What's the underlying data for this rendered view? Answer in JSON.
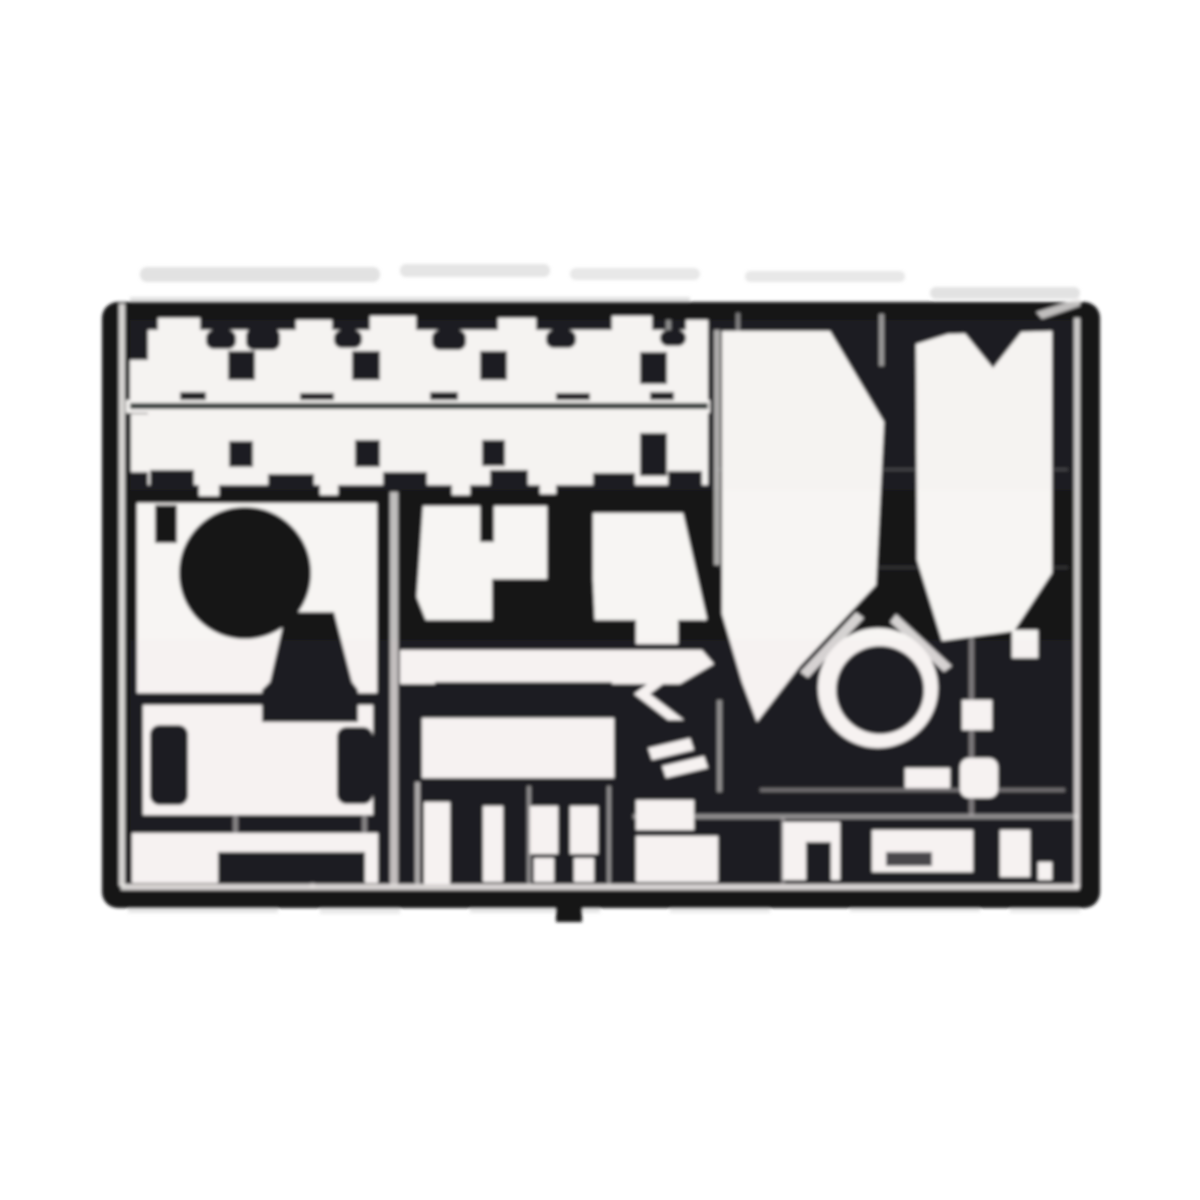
{
  "meta": {
    "subject": "photo-etched-parts-fret-scan",
    "background_color": "#ffffff"
  },
  "palette": {
    "bg": "#ffffff",
    "sheet": "#141418",
    "part": "#f7f5f3",
    "line": "#ebe9e7",
    "divider": "#26302c",
    "noise": "#c6c6c6",
    "noiseDark": "#a8a8a8",
    "tintPink": "#e8c8d2",
    "tintGreen": "#cfe0d4"
  },
  "canvas": {
    "width": 1200,
    "height": 1200,
    "blur": 1.5
  },
  "shapes": [
    {
      "n": "scan-noise-top-1",
      "k": "rect",
      "x": 140,
      "y": 267,
      "w": 240,
      "h": 15,
      "rx": 7,
      "f": "noise",
      "o": 0.5
    },
    {
      "n": "scan-noise-top-2",
      "k": "rect",
      "x": 400,
      "y": 264,
      "w": 150,
      "h": 13,
      "rx": 6,
      "f": "noise",
      "o": 0.45
    },
    {
      "n": "scan-noise-top-3",
      "k": "rect",
      "x": 570,
      "y": 268,
      "w": 130,
      "h": 12,
      "rx": 6,
      "f": "noise",
      "o": 0.4
    },
    {
      "n": "scan-noise-top-4",
      "k": "rect",
      "x": 745,
      "y": 271,
      "w": 160,
      "h": 11,
      "rx": 5,
      "f": "noise",
      "o": 0.4
    },
    {
      "n": "scan-noise-top-5",
      "k": "rect",
      "x": 930,
      "y": 287,
      "w": 150,
      "h": 12,
      "rx": 6,
      "f": "noise",
      "o": 0.5
    },
    {
      "n": "scan-noise-top-edge",
      "k": "rect",
      "x": 130,
      "y": 297,
      "w": 560,
      "h": 12,
      "f": "noiseDark",
      "o": 0.35
    },
    {
      "n": "scan-noise-bottom-1",
      "k": "rect",
      "x": 128,
      "y": 903,
      "w": 150,
      "h": 10,
      "f": "noise",
      "o": 0.4
    },
    {
      "n": "scan-noise-bottom-2",
      "k": "rect",
      "x": 320,
      "y": 906,
      "w": 80,
      "h": 8,
      "f": "noise",
      "o": 0.35
    },
    {
      "n": "scan-noise-bottom-3",
      "k": "rect",
      "x": 470,
      "y": 904,
      "w": 130,
      "h": 9,
      "f": "noise",
      "o": 0.4
    },
    {
      "n": "scan-noise-bottom-4",
      "k": "rect",
      "x": 670,
      "y": 905,
      "w": 100,
      "h": 8,
      "f": "noise",
      "o": 0.35
    },
    {
      "n": "scan-noise-bottom-5",
      "k": "rect",
      "x": 850,
      "y": 903,
      "w": 130,
      "h": 9,
      "f": "noise",
      "o": 0.4
    },
    {
      "n": "scan-noise-bottom-6",
      "k": "rect",
      "x": 1010,
      "y": 905,
      "w": 70,
      "h": 8,
      "f": "noise",
      "o": 0.35
    },
    {
      "n": "fret-sheet",
      "k": "rect",
      "x": 102,
      "y": 302,
      "w": 998,
      "h": 606,
      "rx": 16,
      "f": "sheet"
    },
    {
      "n": "sprue-tab-bottom",
      "k": "rect",
      "x": 556,
      "y": 886,
      "w": 26,
      "h": 36,
      "f": "sheet"
    },
    {
      "n": "frame-line-left",
      "k": "rect",
      "x": 119,
      "y": 304,
      "w": 6,
      "h": 582,
      "f": "line",
      "o": 0.9
    },
    {
      "n": "frame-line-right",
      "k": "rect",
      "x": 1074,
      "y": 318,
      "w": 6,
      "h": 570,
      "f": "line",
      "o": 0.85
    },
    {
      "n": "frame-line-bottom",
      "k": "rect",
      "x": 121,
      "y": 884,
      "w": 958,
      "h": 6,
      "f": "line",
      "o": 0.9
    },
    {
      "n": "frame-corner-top-right",
      "k": "polygon",
      "pts": "1036,312 1080,298 1080,306 1042,319",
      "f": "line",
      "o": 0.8
    },
    {
      "n": "sprue-line-v-392",
      "k": "rect",
      "x": 390,
      "y": 487,
      "w": 8,
      "h": 398,
      "f": "line",
      "o": 0.8
    },
    {
      "n": "sprue-line-v-637",
      "k": "rect",
      "x": 636,
      "y": 316,
      "w": 4,
      "h": 70,
      "f": "line",
      "o": 0.5
    },
    {
      "n": "sprue-line-v-668",
      "k": "rect",
      "x": 666,
      "y": 320,
      "w": 5,
      "h": 165,
      "f": "line",
      "o": 0.55
    },
    {
      "n": "sprue-line-v-716-top",
      "k": "rect",
      "x": 714,
      "y": 330,
      "w": 6,
      "h": 235,
      "f": "line",
      "o": 0.7
    },
    {
      "n": "sprue-line-v-720-bottom",
      "k": "rect",
      "x": 717,
      "y": 700,
      "w": 5,
      "h": 92,
      "f": "line",
      "o": 0.55
    },
    {
      "n": "sprue-line-v-881",
      "k": "rect",
      "x": 879,
      "y": 314,
      "w": 5,
      "h": 52,
      "f": "line",
      "o": 0.6
    },
    {
      "n": "sprue-line-v-737",
      "k": "rect",
      "x": 736,
      "y": 313,
      "w": 4,
      "h": 24,
      "f": "line",
      "o": 0.5
    },
    {
      "n": "sprue-line-v-971",
      "k": "rect",
      "x": 969,
      "y": 610,
      "w": 5,
      "h": 205,
      "f": "line",
      "o": 0.45
    },
    {
      "n": "sprue-line-v-417",
      "k": "rect",
      "x": 415,
      "y": 782,
      "w": 5,
      "h": 102,
      "f": "line",
      "o": 0.7
    },
    {
      "n": "sprue-line-v-529",
      "k": "rect",
      "x": 527,
      "y": 786,
      "w": 4,
      "h": 98,
      "f": "line",
      "o": 0.55
    },
    {
      "n": "sprue-line-v-609",
      "k": "rect",
      "x": 607,
      "y": 786,
      "w": 4,
      "h": 98,
      "f": "line",
      "o": 0.55
    },
    {
      "n": "sprue-line-v-234",
      "k": "rect",
      "x": 233,
      "y": 812,
      "w": 5,
      "h": 24,
      "f": "line",
      "o": 0.5
    },
    {
      "n": "sprue-line-v-311",
      "k": "rect",
      "x": 310,
      "y": 850,
      "w": 5,
      "h": 38,
      "f": "line",
      "o": 0.5
    },
    {
      "n": "sprue-line-v-364",
      "k": "rect",
      "x": 362,
      "y": 812,
      "w": 5,
      "h": 24,
      "f": "line",
      "o": 0.5
    },
    {
      "n": "sprue-line-v-783",
      "k": "rect",
      "x": 781,
      "y": 818,
      "w": 4,
      "h": 66,
      "f": "line",
      "o": 0.45
    },
    {
      "n": "sprue-line-h-470",
      "k": "rect",
      "x": 718,
      "y": 468,
      "w": 350,
      "h": 3,
      "f": "line",
      "o": 0.18
    },
    {
      "n": "sprue-line-h-567",
      "k": "rect",
      "x": 718,
      "y": 566,
      "w": 350,
      "h": 3,
      "f": "line",
      "o": 0.14
    },
    {
      "n": "sprue-line-h-790",
      "k": "rect",
      "x": 760,
      "y": 788,
      "w": 305,
      "h": 4,
      "f": "line",
      "o": 0.4
    },
    {
      "n": "sprue-line-h-816",
      "k": "rect",
      "x": 633,
      "y": 814,
      "w": 445,
      "h": 5,
      "f": "line",
      "o": 0.55
    },
    {
      "n": "zimmerit-band-1",
      "k": "rect",
      "x": 148,
      "y": 330,
      "w": 560,
      "h": 72,
      "f": "part"
    },
    {
      "n": "band1-left-tab",
      "k": "rect",
      "x": 130,
      "y": 360,
      "w": 20,
      "h": 42,
      "f": "part"
    },
    {
      "n": "band1-peak-1",
      "k": "rect",
      "x": 158,
      "y": 318,
      "w": 42,
      "h": 16,
      "f": "part"
    },
    {
      "n": "band1-peak-2",
      "k": "rect",
      "x": 296,
      "y": 320,
      "w": 36,
      "h": 14,
      "f": "part"
    },
    {
      "n": "band1-peak-3",
      "k": "rect",
      "x": 370,
      "y": 316,
      "w": 46,
      "h": 16,
      "f": "part"
    },
    {
      "n": "band1-peak-4",
      "k": "rect",
      "x": 498,
      "y": 318,
      "w": 38,
      "h": 14,
      "f": "part"
    },
    {
      "n": "band1-peak-5",
      "k": "rect",
      "x": 612,
      "y": 316,
      "w": 40,
      "h": 16,
      "f": "part"
    },
    {
      "n": "band1-peak-6",
      "k": "rect",
      "x": 686,
      "y": 320,
      "w": 22,
      "h": 12,
      "f": "part"
    },
    {
      "n": "band1-dip-1",
      "k": "rect",
      "x": 206,
      "y": 330,
      "w": 30,
      "h": 19,
      "rx": 8,
      "f": "sheet"
    },
    {
      "n": "band1-dip-2",
      "k": "rect",
      "x": 246,
      "y": 328,
      "w": 34,
      "h": 22,
      "rx": 8,
      "f": "sheet"
    },
    {
      "n": "band1-dip-3",
      "k": "rect",
      "x": 334,
      "y": 330,
      "w": 28,
      "h": 18,
      "rx": 8,
      "f": "sheet"
    },
    {
      "n": "band1-dip-4",
      "k": "rect",
      "x": 432,
      "y": 330,
      "w": 34,
      "h": 20,
      "rx": 8,
      "f": "sheet"
    },
    {
      "n": "band1-dip-5",
      "k": "rect",
      "x": 546,
      "y": 330,
      "w": 30,
      "h": 18,
      "rx": 8,
      "f": "sheet"
    },
    {
      "n": "band1-dip-6",
      "k": "rect",
      "x": 660,
      "y": 330,
      "w": 26,
      "h": 16,
      "rx": 8,
      "f": "sheet"
    },
    {
      "n": "band1-square-hole-1",
      "k": "rect",
      "x": 228,
      "y": 351,
      "w": 27,
      "h": 29,
      "f": "sheet"
    },
    {
      "n": "band1-square-hole-2",
      "k": "rect",
      "x": 352,
      "y": 351,
      "w": 28,
      "h": 29,
      "f": "sheet"
    },
    {
      "n": "band1-square-hole-3",
      "k": "rect",
      "x": 480,
      "y": 351,
      "w": 27,
      "h": 29,
      "f": "sheet"
    },
    {
      "n": "band1-square-hole-4",
      "k": "rect",
      "x": 640,
      "y": 352,
      "w": 27,
      "h": 32,
      "f": "sheet"
    },
    {
      "n": "band1-tooth-1",
      "k": "rect",
      "x": 180,
      "y": 392,
      "w": 26,
      "h": 12,
      "f": "sheet"
    },
    {
      "n": "band1-tooth-2",
      "k": "rect",
      "x": 300,
      "y": 393,
      "w": 34,
      "h": 11,
      "f": "sheet"
    },
    {
      "n": "band1-tooth-3",
      "k": "rect",
      "x": 430,
      "y": 392,
      "w": 28,
      "h": 12,
      "f": "sheet"
    },
    {
      "n": "band1-tooth-4",
      "k": "rect",
      "x": 556,
      "y": 393,
      "w": 34,
      "h": 11,
      "f": "sheet"
    },
    {
      "n": "band1-tooth-5",
      "k": "rect",
      "x": 650,
      "y": 392,
      "w": 24,
      "h": 12,
      "f": "sheet"
    },
    {
      "n": "divider-white-strip",
      "k": "rect",
      "x": 126,
      "y": 400,
      "w": 584,
      "h": 13,
      "f": "part"
    },
    {
      "n": "divider-dark-line",
      "k": "rect",
      "x": 130,
      "y": 403,
      "w": 578,
      "h": 6,
      "f": "divider"
    },
    {
      "n": "zimmerit-band-2",
      "k": "rect",
      "x": 148,
      "y": 413,
      "w": 560,
      "h": 72,
      "f": "part"
    },
    {
      "n": "band2-left-tab",
      "k": "rect",
      "x": 131,
      "y": 414,
      "w": 19,
      "h": 58,
      "f": "part"
    },
    {
      "n": "band2-square-hole-1",
      "k": "rect",
      "x": 229,
      "y": 441,
      "w": 24,
      "h": 26,
      "f": "sheet"
    },
    {
      "n": "band2-square-hole-2",
      "k": "rect",
      "x": 355,
      "y": 440,
      "w": 25,
      "h": 27,
      "f": "sheet"
    },
    {
      "n": "band2-square-hole-3",
      "k": "rect",
      "x": 482,
      "y": 440,
      "w": 23,
      "h": 26,
      "f": "sheet"
    },
    {
      "n": "band2-square-hole-4",
      "k": "rect",
      "x": 640,
      "y": 433,
      "w": 27,
      "h": 43,
      "f": "sheet"
    },
    {
      "n": "band2-tooth-1",
      "k": "rect",
      "x": 150,
      "y": 470,
      "w": 44,
      "h": 22,
      "f": "sheet"
    },
    {
      "n": "band2-tooth-2",
      "k": "rect",
      "x": 268,
      "y": 474,
      "w": 46,
      "h": 18,
      "f": "sheet"
    },
    {
      "n": "band2-tooth-3",
      "k": "rect",
      "x": 383,
      "y": 472,
      "w": 44,
      "h": 20,
      "f": "sheet"
    },
    {
      "n": "band2-tooth-4",
      "k": "rect",
      "x": 490,
      "y": 470,
      "w": 38,
      "h": 22,
      "f": "sheet"
    },
    {
      "n": "band2-tooth-5",
      "k": "rect",
      "x": 593,
      "y": 473,
      "w": 42,
      "h": 19,
      "f": "sheet"
    },
    {
      "n": "band2-tooth-6",
      "k": "rect",
      "x": 668,
      "y": 471,
      "w": 34,
      "h": 20,
      "f": "sheet"
    },
    {
      "n": "band2-nub-1",
      "k": "rect",
      "x": 199,
      "y": 480,
      "w": 20,
      "h": 16,
      "f": "part"
    },
    {
      "n": "band2-nub-2",
      "k": "rect",
      "x": 320,
      "y": 482,
      "w": 18,
      "h": 13,
      "f": "part"
    },
    {
      "n": "band2-nub-3",
      "k": "rect",
      "x": 452,
      "y": 480,
      "w": 18,
      "h": 15,
      "f": "part"
    },
    {
      "n": "band2-nub-4",
      "k": "rect",
      "x": 540,
      "y": 482,
      "w": 16,
      "h": 12,
      "f": "part"
    },
    {
      "n": "left-panel-upper",
      "k": "rect",
      "x": 137,
      "y": 503,
      "w": 240,
      "h": 190,
      "f": "part"
    },
    {
      "n": "left-panel-lower",
      "k": "rect",
      "x": 143,
      "y": 705,
      "w": 230,
      "h": 110,
      "f": "part"
    },
    {
      "n": "left-strip-bottom",
      "k": "rect",
      "x": 132,
      "y": 833,
      "w": 246,
      "h": 50,
      "f": "part"
    },
    {
      "n": "large-disc-hole",
      "k": "circle",
      "cx": 245,
      "cy": 573,
      "r": 66,
      "f": "sheet"
    },
    {
      "n": "funnel-cutout",
      "k": "polygon",
      "pts": "286,612 334,612 352,682 358,690 358,722 262,722 262,690 270,682",
      "f": "sheet"
    },
    {
      "n": "panel-tab-cutout",
      "k": "rect",
      "x": 155,
      "y": 505,
      "w": 22,
      "h": 38,
      "f": "sheet"
    },
    {
      "n": "knob-cutout-1",
      "k": "rect",
      "x": 150,
      "y": 725,
      "w": 38,
      "h": 80,
      "rx": 10,
      "f": "sheet"
    },
    {
      "n": "knob-cutout-2",
      "k": "rect",
      "x": 337,
      "y": 727,
      "w": 36,
      "h": 77,
      "rx": 10,
      "f": "sheet"
    },
    {
      "n": "bottom-strip-bar",
      "k": "rect",
      "x": 218,
      "y": 852,
      "w": 147,
      "h": 31,
      "f": "sheet"
    },
    {
      "n": "mid-panel-left",
      "k": "polygon",
      "pts": "402,506 547,506 547,623 427,623 402,560",
      "f": "part"
    },
    {
      "n": "mid-panel-right",
      "k": "polygon",
      "pts": "593,513 683,513 707,619 698,625 595,625 593,580",
      "f": "part"
    },
    {
      "n": "mid-wedge-cutout",
      "k": "polygon",
      "pts": "399,506 423,506 412,664 403,664",
      "f": "sheet"
    },
    {
      "n": "mid-tab-cutout",
      "k": "rect",
      "x": 480,
      "y": 506,
      "w": 14,
      "h": 36,
      "f": "sheet"
    },
    {
      "n": "mid-rect-cutout",
      "k": "rect",
      "x": 492,
      "y": 579,
      "w": 78,
      "h": 46,
      "f": "sheet"
    },
    {
      "n": "mid-bench-bar",
      "k": "rect",
      "x": 402,
      "y": 620,
      "w": 302,
      "h": 32,
      "f": "sheet"
    },
    {
      "n": "mid-arrow-bar",
      "k": "polygon",
      "pts": "400,650 702,650 714,664 680,684 400,684",
      "f": "part"
    },
    {
      "n": "mid-under-bar",
      "k": "rect",
      "x": 435,
      "y": 682,
      "w": 177,
      "h": 34,
      "f": "sheet"
    },
    {
      "n": "mid-block",
      "k": "rect",
      "x": 422,
      "y": 718,
      "w": 192,
      "h": 60,
      "f": "part"
    },
    {
      "n": "small-part-1",
      "k": "rect",
      "x": 424,
      "y": 802,
      "w": 26,
      "h": 82,
      "f": "part"
    },
    {
      "n": "small-part-2",
      "k": "rect",
      "x": 483,
      "y": 806,
      "w": 20,
      "h": 76,
      "f": "part"
    },
    {
      "n": "small-part-3a",
      "k": "rect",
      "x": 530,
      "y": 806,
      "w": 28,
      "h": 48,
      "f": "part"
    },
    {
      "n": "small-part-3b",
      "k": "rect",
      "x": 534,
      "y": 858,
      "w": 20,
      "h": 24,
      "f": "part"
    },
    {
      "n": "small-part-4a",
      "k": "rect",
      "x": 570,
      "y": 806,
      "w": 28,
      "h": 48,
      "f": "part"
    },
    {
      "n": "small-part-4b",
      "k": "rect",
      "x": 574,
      "y": 858,
      "w": 20,
      "h": 24,
      "f": "part"
    },
    {
      "n": "center-bit-square",
      "k": "rect",
      "x": 636,
      "y": 608,
      "w": 42,
      "h": 36,
      "f": "part"
    },
    {
      "n": "center-chevron-part",
      "k": "polygon",
      "pts": "684,668 668,668 634,694 668,720 684,720 650,694",
      "f": "part"
    },
    {
      "n": "center-sliver-1",
      "k": "polygon",
      "pts": "648,748 690,738 694,750 652,760",
      "f": "part"
    },
    {
      "n": "center-sliver-2",
      "k": "polygon",
      "pts": "662,766 704,756 708,768 666,778",
      "f": "part"
    },
    {
      "n": "center-bit-low-1",
      "k": "rect",
      "x": 636,
      "y": 800,
      "w": 58,
      "h": 30,
      "f": "part"
    },
    {
      "n": "center-bit-low-2",
      "k": "rect",
      "x": 636,
      "y": 836,
      "w": 82,
      "h": 46,
      "f": "part"
    },
    {
      "n": "fender-panel-left",
      "k": "polygon",
      "pts": "722,331 830,331 884,422 876,585 800,666 757,722 742,682 722,614",
      "f": "part"
    },
    {
      "n": "fender-panel-right",
      "k": "polygon",
      "pts": "916,344 948,334 1052,331 1052,573 1014,631 942,641 917,560",
      "f": "part"
    },
    {
      "n": "fender-notch-cutout",
      "k": "polygon",
      "pts": "963,331 1022,331 993,368",
      "f": "sheet"
    },
    {
      "n": "mantlet-edge-left",
      "k": "polygon",
      "pts": "800,672 856,612 864,618 808,678",
      "f": "part",
      "o": 0.85
    },
    {
      "n": "mantlet-edge-right",
      "k": "polygon",
      "pts": "896,614 952,666 944,672 890,622",
      "f": "part",
      "o": 0.85
    },
    {
      "n": "wheel-ring-outer",
      "k": "circle",
      "cx": 878,
      "cy": 688,
      "r": 60,
      "f": "part"
    },
    {
      "n": "wheel-hub-hole",
      "k": "circle",
      "cx": 880,
      "cy": 690,
      "r": 44,
      "f": "sheet"
    },
    {
      "n": "small-square-part",
      "k": "rect",
      "x": 962,
      "y": 700,
      "w": 30,
      "h": 30,
      "f": "part"
    },
    {
      "n": "small-blob-part",
      "k": "rect",
      "x": 960,
      "y": 758,
      "w": 38,
      "h": 40,
      "rx": 9,
      "f": "part"
    },
    {
      "n": "fender-lip-part",
      "k": "rect",
      "x": 1012,
      "y": 630,
      "w": 26,
      "h": 28,
      "f": "part"
    },
    {
      "n": "small-bit-part",
      "k": "rect",
      "x": 905,
      "y": 768,
      "w": 45,
      "h": 20,
      "f": "part"
    },
    {
      "n": "bottom-right-part-1",
      "k": "rect",
      "x": 783,
      "y": 822,
      "w": 57,
      "h": 58,
      "f": "part"
    },
    {
      "n": "bottom-right-part-1-cut",
      "k": "rect",
      "x": 806,
      "y": 842,
      "w": 25,
      "h": 38,
      "f": "sheet"
    },
    {
      "n": "bottom-right-part-2",
      "k": "rect",
      "x": 872,
      "y": 830,
      "w": 101,
      "h": 42,
      "f": "part"
    },
    {
      "n": "bottom-right-part-2-cut",
      "k": "rect",
      "x": 886,
      "y": 852,
      "w": 46,
      "h": 14,
      "f": "sheet",
      "o": 0.8
    },
    {
      "n": "bottom-right-part-3",
      "k": "rect",
      "x": 1000,
      "y": 830,
      "w": 30,
      "h": 47,
      "f": "part"
    },
    {
      "n": "bottom-right-foot",
      "k": "rect",
      "x": 1038,
      "y": 862,
      "w": 14,
      "h": 18,
      "f": "part"
    },
    {
      "n": "scan-tint-pink",
      "k": "rect",
      "x": 130,
      "y": 640,
      "w": 950,
      "h": 250,
      "f": "tintPink",
      "o": 0.05
    },
    {
      "n": "scan-tint-green",
      "k": "rect",
      "x": 130,
      "y": 320,
      "w": 950,
      "h": 170,
      "f": "tintGreen",
      "o": 0.05
    }
  ]
}
